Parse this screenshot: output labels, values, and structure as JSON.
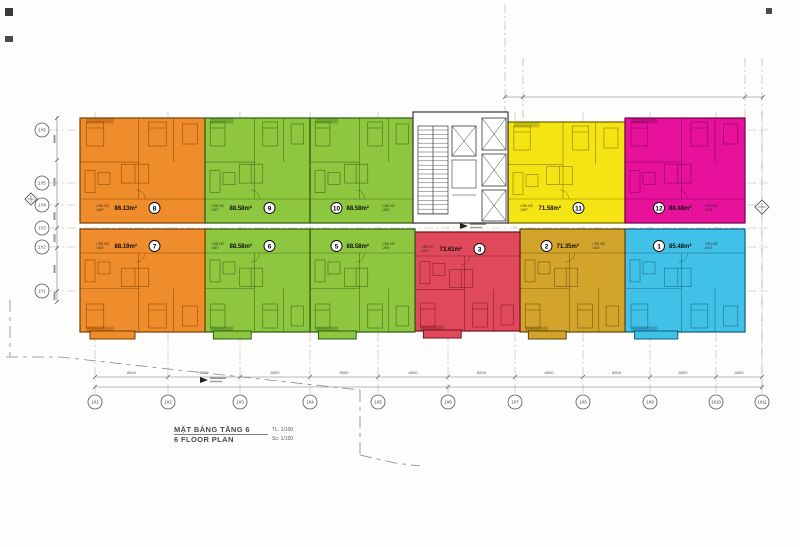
{
  "title": {
    "vn": "MẶT BẰNG TẦNG 6",
    "en": "6 FLOOR PLAN",
    "scale_tl": "TL: 1/100",
    "scale_sc": "Sc: 1/100"
  },
  "units": [
    {
      "num": "1",
      "area": "85.48m²",
      "tag_vn": "CĂN HỘ",
      "tag_en": "UNIT",
      "color": "#41C0E8",
      "line": "#0B5E7E"
    },
    {
      "num": "2",
      "area": "71.35m²",
      "tag_vn": "CĂN HỘ",
      "tag_en": "UNIT",
      "color": "#D2A42C",
      "line": "#5E4708"
    },
    {
      "num": "3",
      "area": "73.61m²",
      "tag_vn": "CĂN HỘ",
      "tag_en": "UNIT",
      "color": "#E0495C",
      "line": "#731022"
    },
    {
      "num": "5",
      "area": "88.58m²",
      "tag_vn": "CĂN HỘ",
      "tag_en": "UNIT",
      "color": "#8DC63F",
      "line": "#2F5A10"
    },
    {
      "num": "6",
      "area": "88.58m²",
      "tag_vn": "CĂN HỘ",
      "tag_en": "UNIT",
      "color": "#8DC63F",
      "line": "#2F5A10"
    },
    {
      "num": "7",
      "area": "88.19m²",
      "tag_vn": "CĂN HỘ",
      "tag_en": "UNIT",
      "color": "#EF8C2B",
      "line": "#7A3E00"
    },
    {
      "num": "8",
      "area": "86.13m²",
      "tag_vn": "CĂN HỘ",
      "tag_en": "UNIT",
      "color": "#EF8C2B",
      "line": "#7A3E00"
    },
    {
      "num": "9",
      "area": "88.58m²",
      "tag_vn": "CĂN HỘ",
      "tag_en": "UNIT",
      "color": "#8DC63F",
      "line": "#2F5A10"
    },
    {
      "num": "10",
      "area": "88.58m²",
      "tag_vn": "CĂN HỘ",
      "tag_en": "UNIT",
      "color": "#8DC63F",
      "line": "#2F5A10"
    },
    {
      "num": "11",
      "area": "71.58m²",
      "tag_vn": "CĂN HỘ",
      "tag_en": "UNIT",
      "color": "#F5E414",
      "line": "#6B6200"
    },
    {
      "num": "12",
      "area": "88.48m²",
      "tag_vn": "CĂN HỘ",
      "tag_en": "UNIT",
      "color": "#E8119B",
      "line": "#6B0548"
    }
  ],
  "grid": {
    "bottom": [
      "1X1",
      "1X2",
      "1X3",
      "1X4",
      "1X5",
      "1X6",
      "1X7",
      "1X8",
      "1X9",
      "1X10",
      "1X11"
    ],
    "left": [
      "1Y6",
      "1Y5",
      "1Y4",
      "1Y3",
      "1Y2",
      "1Y1"
    ]
  },
  "dims": {
    "bottom": [
      "8500",
      "8500",
      "8500",
      "8500",
      "8500",
      "8500",
      "8500",
      "8500",
      "8500",
      "4600"
    ]
  }
}
